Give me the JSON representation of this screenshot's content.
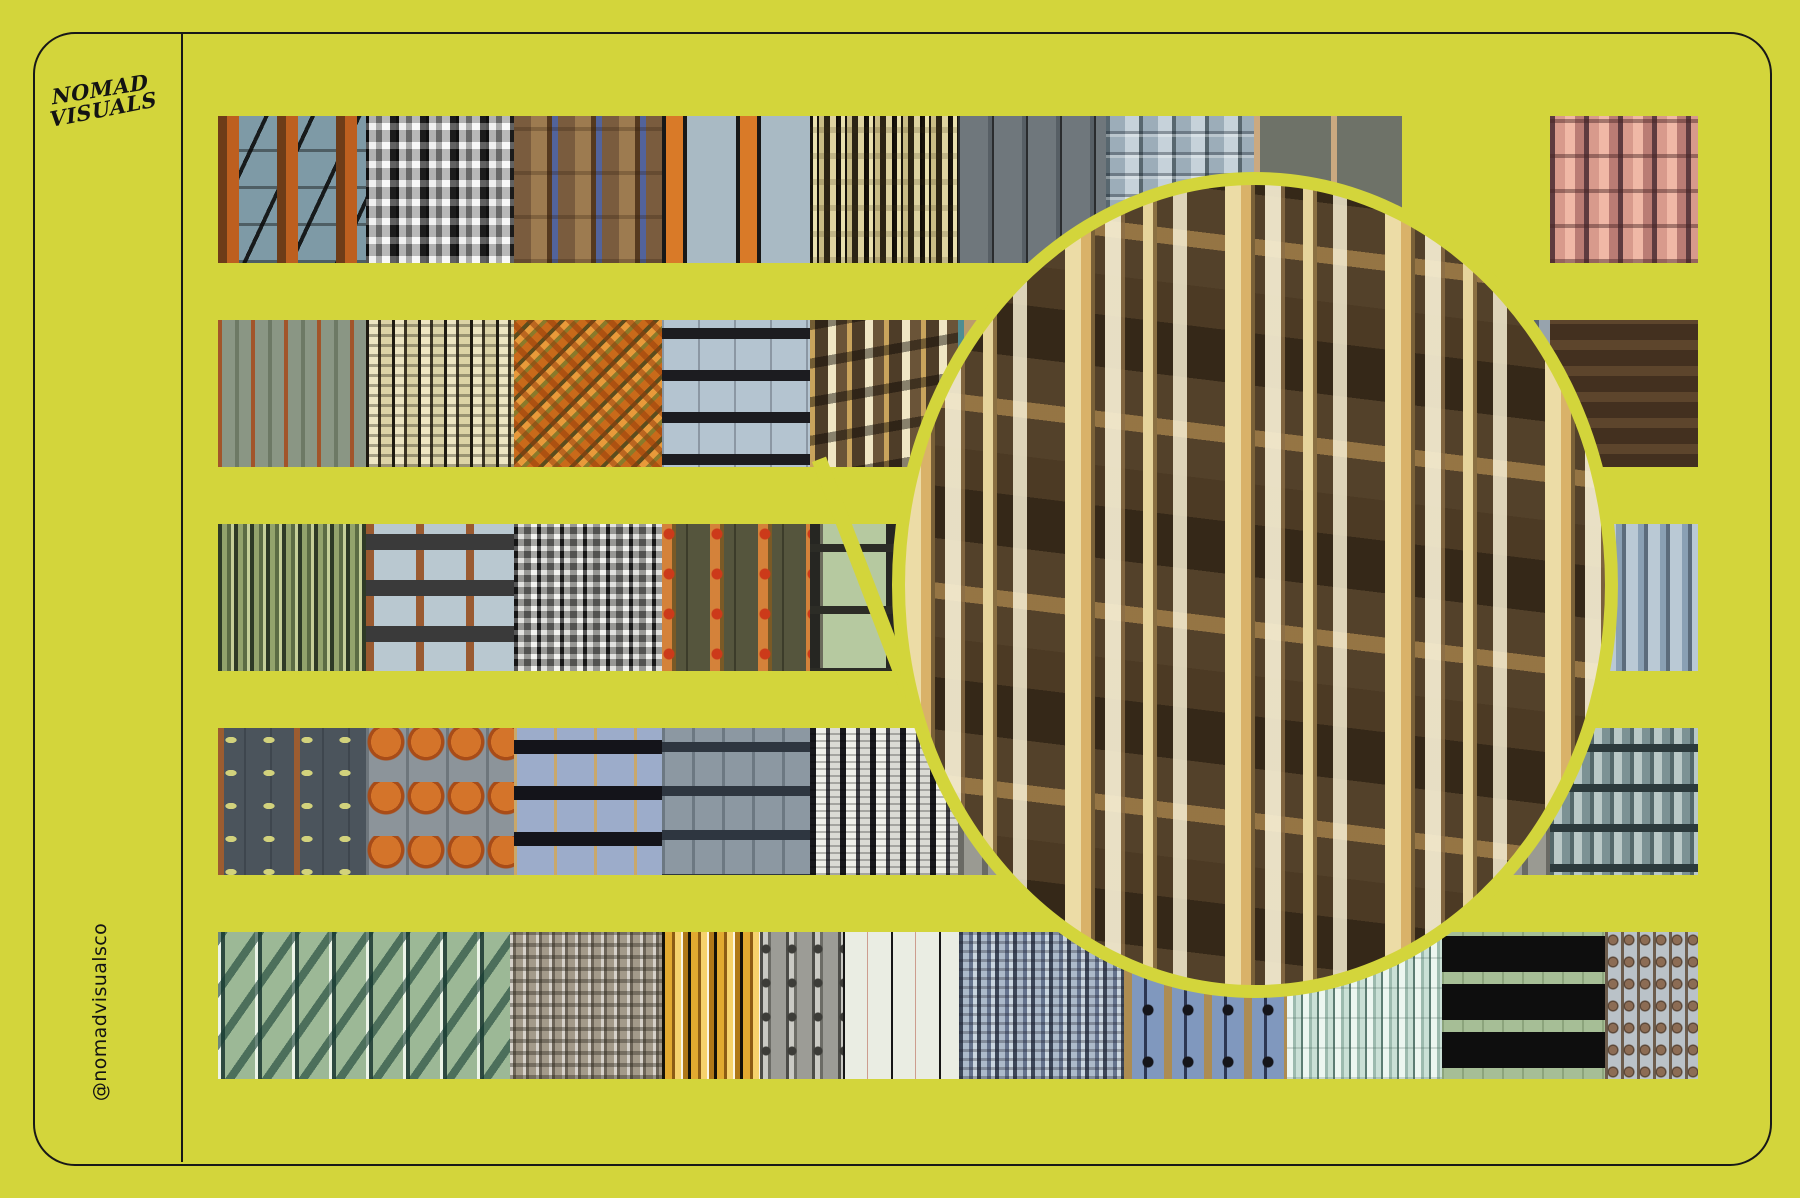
{
  "canvas": {
    "background_color": "#d3d53b",
    "ink_color": "#181818"
  },
  "brand": {
    "logo_line1": "NOMAD",
    "logo_line2": "VISUALS",
    "handle": "@nomadvisualsco"
  },
  "magnifier": {
    "shape": "circle",
    "ring_color": "#d3d53b",
    "content": "enlarged brown building facade with cream pilasters and lit windows",
    "source_tile": "row2-tile5",
    "palette": [
      "#53412a",
      "#ecdca6",
      "#d9b269",
      "#f6eed2",
      "#7a6138"
    ]
  },
  "swatch_rows": [
    {
      "y": 116,
      "tiles": [
        {
          "name": "tile-facade-grid-rust-blue",
          "pattern": "p-r1t1",
          "width": 148,
          "colors": [
            "#7e9aa6",
            "#bd5f1f",
            "#141414"
          ]
        },
        {
          "name": "tile-metallic-silver-stripes",
          "pattern": "p-r1t2",
          "width": 148,
          "colors": [
            "#ececec",
            "#8a8a8a",
            "#141414"
          ]
        },
        {
          "name": "tile-timber-log-columns",
          "pattern": "p-r1t3",
          "width": 148,
          "colors": [
            "#9d7b50",
            "#55391f",
            "#52639b"
          ]
        },
        {
          "name": "tile-orange-bars-on-blue",
          "pattern": "p-r1t4",
          "width": 148,
          "colors": [
            "#a9bac4",
            "#d97a28",
            "#181818"
          ]
        },
        {
          "name": "tile-artdeco-cream-black",
          "pattern": "p-r1t5",
          "width": 148,
          "colors": [
            "#e9e0ae",
            "#17120a"
          ]
        },
        {
          "name": "tile-pale-blue-thin-stripes",
          "pattern": "p-r1t6",
          "width": 148,
          "colors": [
            "#b6c2c8",
            "#2c2c2c"
          ]
        },
        {
          "name": "tile-steel-panel-stripes",
          "pattern": "p-r1t7",
          "width": 148,
          "colors": [
            "#9cadb9",
            "#58676f",
            "#c6d2da"
          ]
        },
        {
          "name": "tile-olive-panels-tan-dividers",
          "pattern": "p-r1t8",
          "width": 148,
          "colors": [
            "#6e7268",
            "#cba980"
          ]
        },
        {
          "name": "tile-diagonal-silver-navy",
          "pattern": "p-r1t9",
          "width": 148,
          "colors": [
            "#23242e",
            "#d2dad4"
          ]
        },
        {
          "name": "tile-salmon-ribbed",
          "pattern": "p-r1t10",
          "width": 148,
          "colors": [
            "#d89a8c",
            "#5e3b3f"
          ]
        }
      ]
    },
    {
      "y": 320,
      "tiles": [
        {
          "name": "tile-sage-rust-pinstripes",
          "pattern": "p-r2t1",
          "width": 148,
          "colors": [
            "#8a9684",
            "#a2552a"
          ]
        },
        {
          "name": "tile-cream-black-ladder-stripes",
          "pattern": "p-r2t2",
          "width": 148,
          "colors": [
            "#eee6c2",
            "#1e1a10"
          ]
        },
        {
          "name": "tile-orange-green-mosaic",
          "pattern": "p-r2t3",
          "width": 148,
          "colors": [
            "#c96a1a",
            "#8a7a2a",
            "#e89a3a"
          ]
        },
        {
          "name": "tile-pale-blue-window-dashes",
          "pattern": "p-r2t4",
          "width": 148,
          "colors": [
            "#b4c4d0",
            "#1c1c20"
          ]
        },
        {
          "name": "tile-brown-lit-facade-magnified-source",
          "pattern": "p-r2t5",
          "width": 148,
          "colors": [
            "#4e3d28",
            "#c9a45c",
            "#f0e6c4"
          ]
        },
        {
          "name": "tile-tan-teal-stripes",
          "pattern": "p-r2t6",
          "width": 148,
          "colors": [
            "#bb9c6c",
            "#4f8d92"
          ]
        },
        {
          "name": "tile-hidden-under-circle-a",
          "pattern": "p-r2t7",
          "width": 148,
          "colors": [
            "#97a3ad"
          ]
        },
        {
          "name": "tile-hidden-under-circle-b",
          "pattern": "p-r2t8",
          "width": 148,
          "colors": [
            "#97a3ad"
          ]
        },
        {
          "name": "tile-hidden-under-circle-c",
          "pattern": "p-r2t9",
          "width": 148,
          "colors": [
            "#97a3ad"
          ]
        },
        {
          "name": "tile-chain-link-brown",
          "pattern": "p-r2t10",
          "width": 148,
          "colors": [
            "#c4b48c",
            "#43301f"
          ]
        }
      ]
    },
    {
      "y": 524,
      "tiles": [
        {
          "name": "tile-olive-fine-stripes",
          "pattern": "p-r3t1",
          "width": 148,
          "colors": [
            "#93a36c",
            "#2e3a26"
          ]
        },
        {
          "name": "tile-pale-blue-rust-columns",
          "pattern": "p-r3t2",
          "width": 148,
          "colors": [
            "#b9c8d0",
            "#9a5a30"
          ]
        },
        {
          "name": "tile-silver-carved-columns",
          "pattern": "p-r3t3",
          "width": 148,
          "colors": [
            "#d8d8d4",
            "#202020"
          ]
        },
        {
          "name": "tile-olive-orange-columns-red-dots",
          "pattern": "p-r3t4",
          "width": 148,
          "colors": [
            "#494832",
            "#d4823a",
            "#cc3a1a"
          ]
        },
        {
          "name": "tile-birch-poles-on-green",
          "pattern": "p-r3t5",
          "width": 148,
          "colors": [
            "#b6c9a0",
            "#262622"
          ]
        },
        {
          "name": "tile-hidden-under-circle-d",
          "pattern": "p-r3t6",
          "width": 148,
          "colors": [
            "#a8b096"
          ]
        },
        {
          "name": "tile-hidden-under-circle-e",
          "pattern": "p-r3t7",
          "width": 148,
          "colors": [
            "#a8b096"
          ]
        },
        {
          "name": "tile-hidden-under-circle-f",
          "pattern": "p-r3t8",
          "width": 148,
          "colors": [
            "#a8b096"
          ]
        },
        {
          "name": "tile-hidden-under-circle-g",
          "pattern": "p-r3t9",
          "width": 148,
          "colors": [
            "#a8b096"
          ]
        },
        {
          "name": "tile-blue-gray-stripes",
          "pattern": "p-r3t10",
          "width": 148,
          "colors": [
            "#8aa0b4",
            "#5c6c7c"
          ]
        }
      ]
    },
    {
      "y": 728,
      "tiles": [
        {
          "name": "tile-slate-yellow-drops",
          "pattern": "p-r4t1",
          "width": 148,
          "colors": [
            "#4b545c",
            "#d2d27c",
            "#9c5c30"
          ]
        },
        {
          "name": "tile-orange-scallop-columns",
          "pattern": "p-r4t2",
          "width": 148,
          "colors": [
            "#8c949a",
            "#d4742a"
          ]
        },
        {
          "name": "tile-periwinkle-window-dashes",
          "pattern": "p-r4t3",
          "width": 148,
          "colors": [
            "#9cacca",
            "#14141a",
            "#c9a86a"
          ]
        },
        {
          "name": "tile-gray-tee-panels",
          "pattern": "p-r4t4",
          "width": 148,
          "colors": [
            "#8c98a2",
            "#2e3640"
          ]
        },
        {
          "name": "tile-white-black-dense-stripes",
          "pattern": "p-r4t5",
          "width": 148,
          "colors": [
            "#f0f0ea",
            "#17171b"
          ]
        },
        {
          "name": "tile-hidden-under-circle-h",
          "pattern": "p-r4t6",
          "width": 148,
          "colors": [
            "#9a9a92"
          ]
        },
        {
          "name": "tile-hidden-under-circle-i",
          "pattern": "p-r4t7",
          "width": 148,
          "colors": [
            "#9a9a92"
          ]
        },
        {
          "name": "tile-hidden-under-circle-j",
          "pattern": "p-r4t8",
          "width": 148,
          "colors": [
            "#9a9a92"
          ]
        },
        {
          "name": "tile-hidden-under-circle-k",
          "pattern": "p-r4t9",
          "width": 148,
          "colors": [
            "#9a9a92"
          ]
        },
        {
          "name": "tile-teal-ornate-columns",
          "pattern": "p-r4t10",
          "width": 148,
          "colors": [
            "#bac9c7",
            "#54686a"
          ]
        }
      ]
    },
    {
      "y": 932,
      "tiles": [
        {
          "name": "tile-green-chevron-facade",
          "pattern": "p-r5t1",
          "width": 292,
          "colors": [
            "#9cb896",
            "#2e4a40",
            "#ecf4e8"
          ]
        },
        {
          "name": "tile-carved-stone-mottle",
          "pattern": "p-r5t2",
          "width": 152,
          "colors": [
            "#a39a8a",
            "#3e382e",
            "#ffffff"
          ]
        },
        {
          "name": "tile-gold-black-stripes",
          "pattern": "p-r5t3",
          "width": 98,
          "colors": [
            "#e2aa30",
            "#141108",
            "#f6d26c"
          ]
        },
        {
          "name": "tile-gray-pipes-joints",
          "pattern": "p-r5t4",
          "width": 83,
          "colors": [
            "#9c9c96",
            "#3c3c38"
          ]
        },
        {
          "name": "tile-white-thin-black-lines",
          "pattern": "p-r5t5",
          "width": 116,
          "colors": [
            "#eaede3",
            "#161616"
          ]
        },
        {
          "name": "tile-carved-blue-columns",
          "pattern": "p-r5t6",
          "width": 165,
          "colors": [
            "#acbaca",
            "#3c4658"
          ]
        },
        {
          "name": "tile-blue-tan-stripes-dots",
          "pattern": "p-r5t7",
          "width": 163,
          "colors": [
            "#8098be",
            "#ad8c52",
            "#15151a"
          ]
        },
        {
          "name": "tile-mint-fine-stripes",
          "pattern": "p-r5t8",
          "width": 155,
          "colors": [
            "#ecf6f0",
            "#5c7c72"
          ]
        },
        {
          "name": "tile-green-black-lattice",
          "pattern": "p-r5t9",
          "width": 163,
          "colors": [
            "#a6be96",
            "#0e0e0e"
          ]
        },
        {
          "name": "tile-gray-figure-stripes",
          "pattern": "p-r5t10",
          "width": 93,
          "colors": [
            "#bac2c8",
            "#8c6c54"
          ]
        }
      ]
    }
  ]
}
